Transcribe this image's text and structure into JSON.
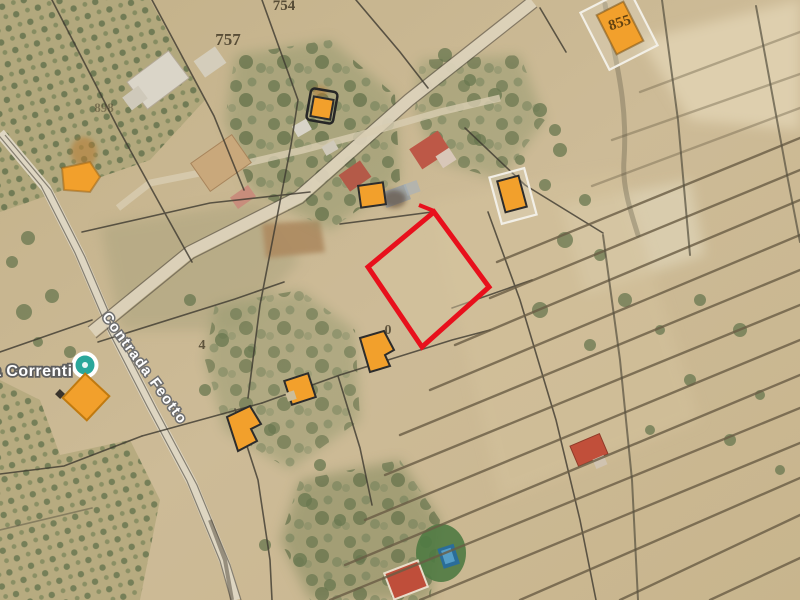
{
  "map": {
    "type": "satellite-cadastral-listing-map",
    "colors": {
      "parcel_outline": "#e8101c",
      "building_highlight": "#f2a02c",
      "building_highlight_stroke": "#2c2c2c",
      "poi_outer": "#ffffff",
      "poi_inner": "#2aa79b",
      "terrain_base": "#c9b68f",
      "number_ink": "#453c28"
    },
    "place_labels": [
      {
        "text": "a Correnti",
        "x": -8,
        "y": 376,
        "size": 16,
        "rot": 0,
        "cls": "lbl-locality",
        "anchor": "start",
        "spacing": 0.5
      },
      {
        "text": "Contrada Feotto",
        "x": 141,
        "y": 371,
        "size": 14.5,
        "rot": 54,
        "cls": "lbl-road",
        "anchor": "middle",
        "spacing": 1.5
      }
    ],
    "parcel_numbers": [
      {
        "text": "754",
        "x": 284,
        "y": 10,
        "size": 15,
        "opacity": 0.85,
        "rot": 0,
        "color": "#453c28"
      },
      {
        "text": "757",
        "x": 228,
        "y": 45,
        "size": 17,
        "opacity": 0.85,
        "rot": 0,
        "color": "#453c28"
      },
      {
        "text": "855",
        "x": 621,
        "y": 27,
        "size": 15,
        "opacity": 0.9,
        "rot": -18,
        "color": "#53380e"
      },
      {
        "text": "898",
        "x": 104,
        "y": 112,
        "size": 13,
        "opacity": 0.5,
        "rot": 0,
        "color": "#453c28"
      },
      {
        "text": "4",
        "x": 202,
        "y": 349,
        "size": 14,
        "opacity": 0.8,
        "rot": 0,
        "color": "#453c28"
      },
      {
        "text": "0",
        "x": 388,
        "y": 334,
        "size": 14,
        "opacity": 0.8,
        "rot": 0,
        "color": "#453c28"
      }
    ],
    "highlight_parcel": {
      "points": "434,212 489,287 422,347 368,267",
      "tail": {
        "x1": 434,
        "y1": 211,
        "x2": 419,
        "y2": 205
      },
      "stroke_width": 5,
      "fill": "rgba(214,197,160,0.5)"
    },
    "poi_marker": {
      "x": 85,
      "y": 365,
      "r_outer": 13.5,
      "r_inner": 9.5
    },
    "orange_buildings": [
      {
        "shape": "rect",
        "cx": 620,
        "cy": 28,
        "w": 30,
        "h": 44,
        "rot": -27,
        "stroke": "rgba(120,80,20,0.55)",
        "outline": {
          "cx": 619,
          "cy": 29,
          "w": 54,
          "h": 64,
          "rot": -27
        }
      },
      {
        "shape": "poly",
        "points": "62,168 90,162 100,177 90,192 64,190",
        "stroke": "rgba(150,95,20,0.5)",
        "smudge": {
          "cx": 84,
          "cy": 152,
          "rx": 13,
          "ry": 15
        }
      },
      {
        "shape": "rect",
        "cx": 322,
        "cy": 108,
        "w": 20,
        "h": 20,
        "rot": 10,
        "stroke": "#2c2c2c",
        "bracket": {
          "cx": 322,
          "cy": 106,
          "w": 27,
          "h": 32,
          "rot": 10
        },
        "smudge": {
          "cx": 320,
          "cy": 92,
          "rx": 8,
          "ry": 6
        }
      },
      {
        "shape": "rect",
        "cx": 372,
        "cy": 195,
        "w": 25,
        "h": 22,
        "rot": -8,
        "stroke": "#2c2c2c"
      },
      {
        "shape": "rect",
        "cx": 512,
        "cy": 194,
        "w": 22,
        "h": 32,
        "rot": -15,
        "stroke": "#2c2c2c",
        "outline": {
          "cx": 513,
          "cy": 196,
          "w": 36,
          "h": 48,
          "rot": -15
        }
      },
      {
        "shape": "rect",
        "cx": 86,
        "cy": 397,
        "w": 33,
        "h": 33,
        "rot": 43,
        "stroke": "#c07a10",
        "mark": {
          "cx": 60,
          "cy": 394,
          "w": 7,
          "h": 7,
          "rot": 43
        }
      },
      {
        "shape": "poly",
        "points": "227,417 250,406 261,424 251,429 257,441 238,451",
        "stroke": "#2c2c2c"
      },
      {
        "shape": "rect",
        "cx": 300,
        "cy": 389,
        "w": 25,
        "h": 25,
        "rot": -18,
        "stroke": "#2c2c2c",
        "notch": {
          "cx": 291,
          "cy": 396,
          "w": 9,
          "h": 9,
          "rot": -18
        }
      },
      {
        "shape": "poly",
        "points": "360,338 384,331 394,350 385,355 390,366 370,372",
        "stroke": "#2c2c2c"
      }
    ]
  }
}
